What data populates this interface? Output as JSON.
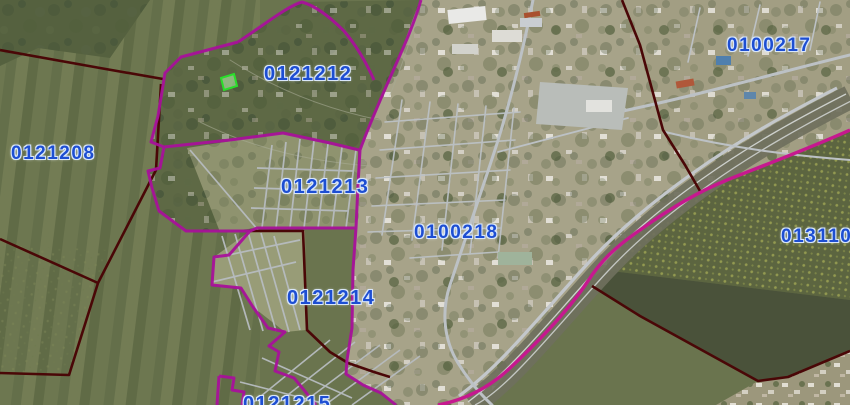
{
  "map": {
    "type": "satellite-cadastre-view",
    "labels": [
      {
        "code": "0121208"
      },
      {
        "code": "0121212"
      },
      {
        "code": "0121213"
      },
      {
        "code": "0100218"
      },
      {
        "code": "0121214"
      },
      {
        "code": "0100217"
      },
      {
        "code": "0131104"
      },
      {
        "code": "0121215"
      }
    ],
    "highlight_parcel": {
      "name": "selected-parcel",
      "stroke": "#2ade2a",
      "fill": "#b9f7b0"
    },
    "colors": {
      "zone_boundary": "#a51297",
      "zone_boundary_bright": "#c6188f",
      "district_boundary": "#4a0707",
      "label_text": "#1d4ed2",
      "label_halo": "#d9e7fb"
    }
  }
}
